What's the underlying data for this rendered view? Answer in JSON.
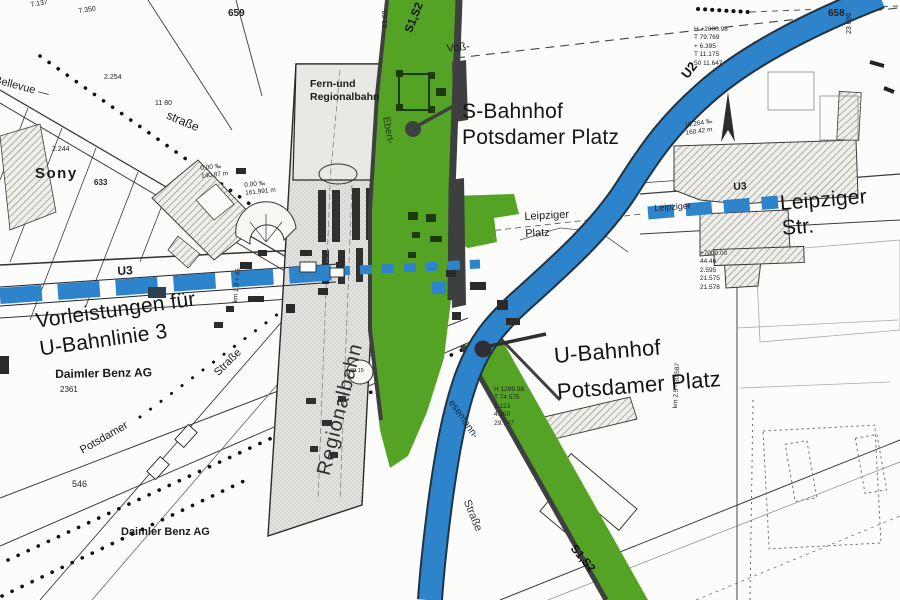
{
  "colors": {
    "sbahn_green": "#54a325",
    "ubahn_blue": "#2d84ca",
    "rail_edge_gray": "#3e4040",
    "band_gray": "#e2e2df",
    "ink": "#141414"
  },
  "stations": {
    "s_bahnhof": "S-Bahnhof\nPotsdamer Platz",
    "u_bahnhof_line1": "U-Bahnhof",
    "u_bahnhof_line2": "Potsdamer Platz"
  },
  "annotations": {
    "vorleistungen": "Vorleistungen für\nU-Bahnlinie 3"
  },
  "rail": {
    "fern_und_regionalbahn": "Fern-und\nRegionalbahn",
    "regionalbahn": "Regionalbahn",
    "s1s2_top": "S1,S2",
    "s1s2_bottom": "S1,S2",
    "u2": "U2",
    "u3_left": "U3",
    "u3_right": "U3"
  },
  "streets": {
    "bellevue": "Bellevue —",
    "strasse_bellevue": "straße",
    "voss": "Voß-",
    "leipziger_str": "Leipziger Str.",
    "leipziger_small": "Leipziger",
    "leipziger_platz": "Leipziger\nPlatz",
    "ebert": "Ebert-",
    "stresemann": "esemann-",
    "strasse_stresemann": "Straße",
    "potsdamer": "Potsdamer",
    "strasse_potsdamer": "Straße"
  },
  "companies": {
    "sony": "Sony",
    "daimler_1": "Daimler  Benz  AG",
    "daimler_2": "Daimler  Benz  AG"
  },
  "numbers": {
    "n659": "659",
    "n658": "658",
    "n2360": "23 60",
    "n23000": "23 000",
    "n7137": "7.137",
    "n7350": "7.350",
    "n2254": "2.254",
    "n2244": "2.244",
    "n633": "633",
    "n1180": "11 80",
    "n546": "546",
    "n2361": "2361",
    "n3015": "30.15",
    "block_a": "H +2000.98\nT 79.769\n+ 6.395\nT 11.175\n50 11.647",
    "block_b": "10.264 ‰\n160.42 m",
    "block_c": "+7000.00\n44.46\n2.595\n21.575\n21.578",
    "block_d": "H 1299.98\nT 74.575\n1.123\n4.250\n29.747",
    "block_e": "0.00 ‰\n140.87 m",
    "block_f": "0.00 ‰\n161.991 m",
    "km_right": "km 2.5 - 30.587",
    "km_left": "km 2.8 + 45"
  }
}
